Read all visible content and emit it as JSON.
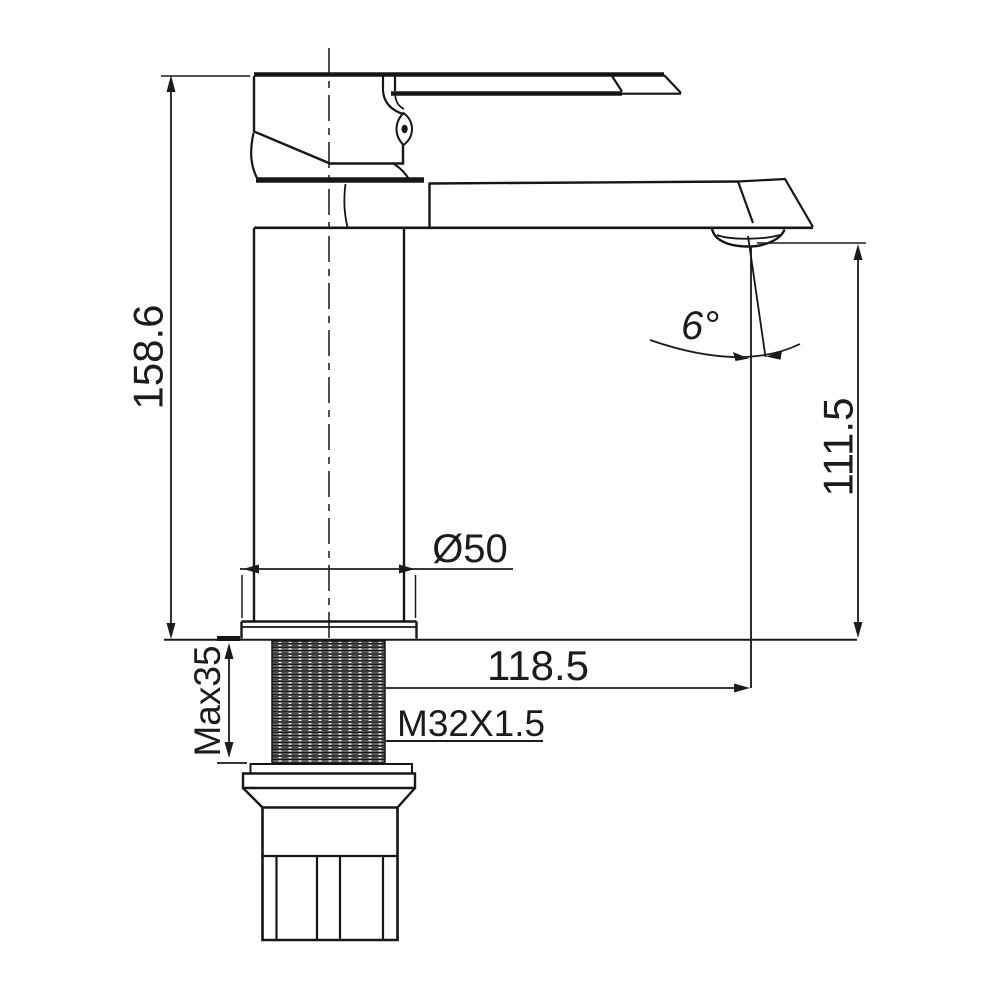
{
  "drawing": {
    "kind": "basin-faucet-dimension-drawing",
    "background_color": "#ffffff",
    "line_color": "#161616",
    "labels": {
      "overall_height": "158.6",
      "spout_height": "111.5",
      "spout_reach": "118.5",
      "base_diameter": "Ø50",
      "max_mounting_thickness": "Max35",
      "thread_spec": "M32X1.5",
      "spout_angle": "6°"
    }
  }
}
